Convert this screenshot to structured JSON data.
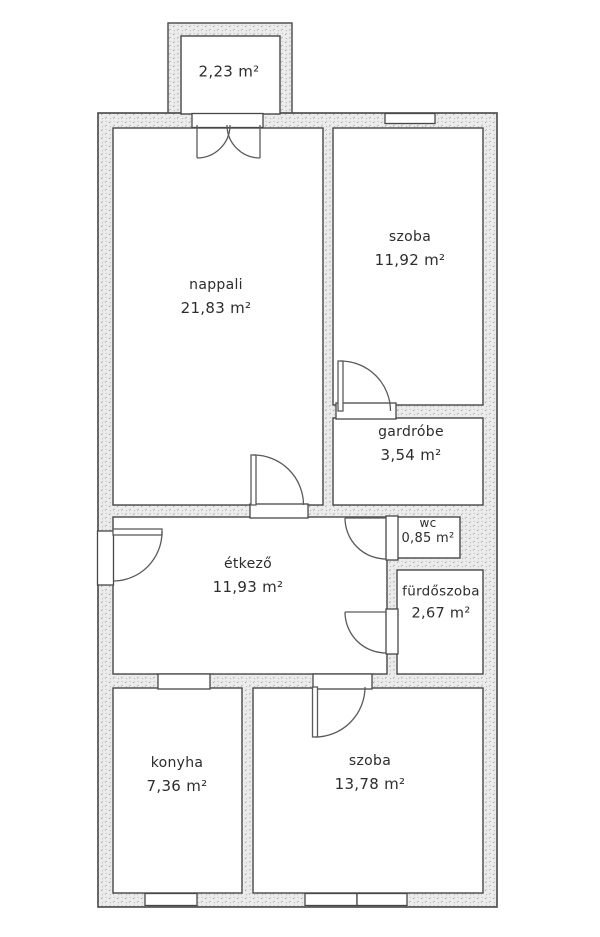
{
  "floorplan": {
    "rooms": [
      {
        "name": "",
        "area": "2,23 m²"
      },
      {
        "name": "nappali",
        "area": "21,83 m²"
      },
      {
        "name": "szoba",
        "area": "11,92 m²"
      },
      {
        "name": "gardróbe",
        "area": "3,54 m²"
      },
      {
        "name": "wc",
        "area": "0,85 m²"
      },
      {
        "name": "étkező",
        "area": "11,93 m²"
      },
      {
        "name": "fürdőszoba",
        "area": "2,67 m²"
      },
      {
        "name": "konyha",
        "area": "7,36 m²"
      },
      {
        "name": "szoba",
        "area": "13,78 m²"
      }
    ],
    "colors": {
      "background": "#ffffff",
      "wall_fill": "#ececec",
      "wall_speckle": "#9a9a9a",
      "line": "#474747",
      "door_line": "#5a5a5a",
      "text": "#2d2d2d"
    }
  }
}
